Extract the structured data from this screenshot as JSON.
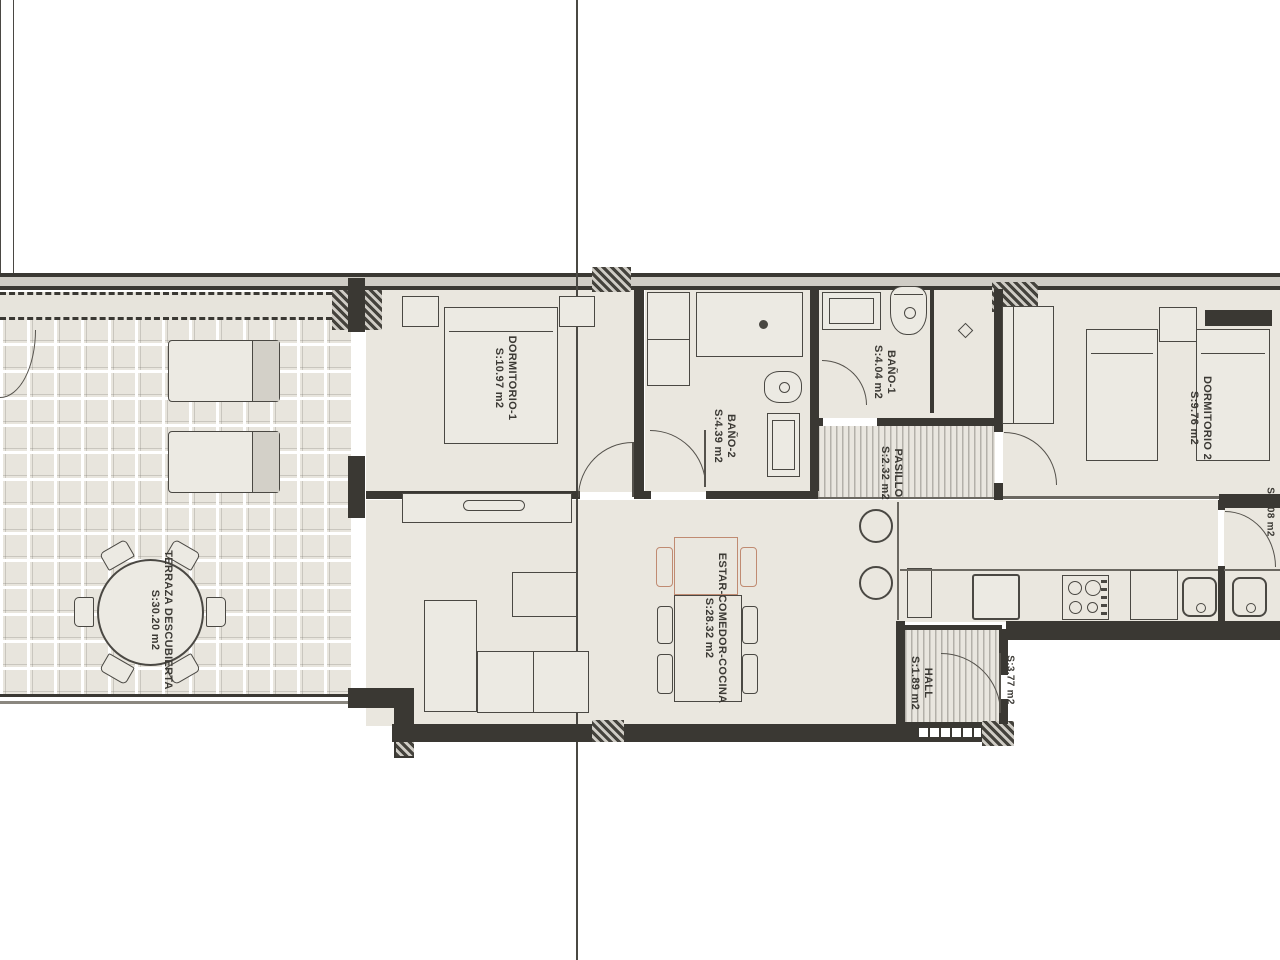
{
  "document": {
    "type": "apartment floor plan",
    "background": "#ffffff"
  },
  "colors": {
    "wall": "#3a3833",
    "thin_line": "#55524c",
    "room_fill": "#eae7df",
    "terrace_tile": "#e8e5dd",
    "hatch_stripe": "#b3b0a9",
    "accent_salmon": "#c08b72",
    "label_text": "#3b3934"
  },
  "rooms": [
    {
      "id": "terraza",
      "name": "TERRAZA DESCUBIERTA",
      "area": "S:30.20 m2"
    },
    {
      "id": "dormitorio1",
      "name": "DORMITORIO-1",
      "area": "S:10.97 m2"
    },
    {
      "id": "bano2",
      "name": "BAÑO-2",
      "area": "S:4.39 m2"
    },
    {
      "id": "bano1",
      "name": "BAÑO-1",
      "area": "S:4.04 m2"
    },
    {
      "id": "pasillo",
      "name": "PASILLO",
      "area": "S:2.32 m2"
    },
    {
      "id": "dormitorio2",
      "name": "DORMITORIO 2",
      "area": "S:9.76 m2"
    },
    {
      "id": "estar",
      "name": "ESTAR-COMEDOR-COCINA",
      "area": "S:28.32 m2"
    },
    {
      "id": "hall",
      "name": "HALL",
      "area": "S:1.89 m2"
    },
    {
      "id": "rellano",
      "name": "",
      "area": "S:3.77 m2"
    },
    {
      "id": "galeria",
      "name": "",
      "area": "S:2.08 m2"
    }
  ]
}
